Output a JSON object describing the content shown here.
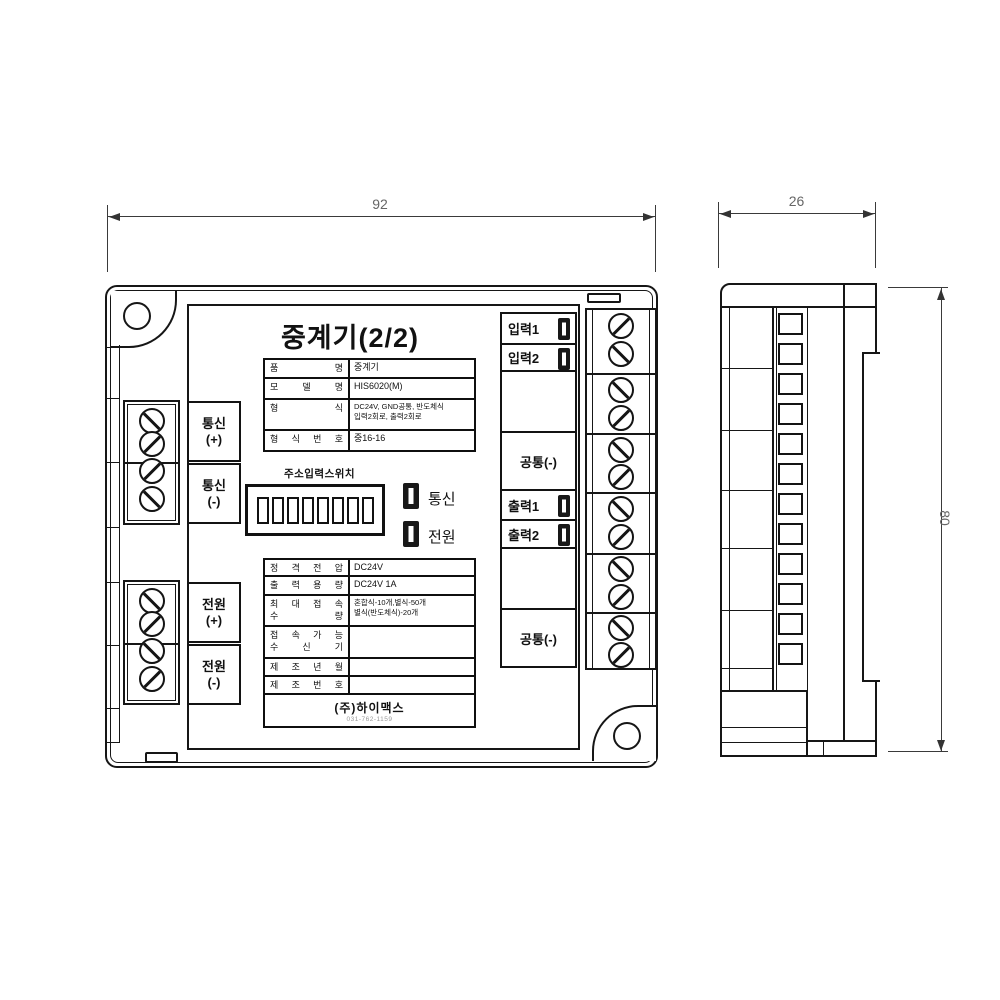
{
  "dimensions": {
    "front_width_mm": "92",
    "side_depth_mm": "26",
    "height_mm": "80"
  },
  "front": {
    "title": "중계기(2/2)",
    "dip_switch_label": "주소입력스위치",
    "status_leds": [
      {
        "label": "통신"
      },
      {
        "label": "전원"
      }
    ],
    "left_terminals": [
      {
        "name": "통신",
        "polarity": "(+)"
      },
      {
        "name": "통신",
        "polarity": "(-)"
      },
      {
        "name": "전원",
        "polarity": "(+)"
      },
      {
        "name": "전원",
        "polarity": "(-)"
      }
    ],
    "right_terminals": {
      "input1": "입력1",
      "input2": "입력2",
      "common_top": "공통(-)",
      "output1": "출력1",
      "output2": "출력2",
      "common_bottom": "공통(-)"
    },
    "spec_table": {
      "rows": [
        {
          "label": "품 명",
          "value": "중계기"
        },
        {
          "label": "모 델 명",
          "value": "HIS6020(M)"
        },
        {
          "label": "형 식",
          "value": "DC24V, GND공통, 반도체식",
          "value2": "입력2회로, 출력2회로"
        },
        {
          "label": "형 식 번 호",
          "value": "중16-16"
        }
      ]
    },
    "info_table": {
      "rows": [
        {
          "label": "정 격 전 압",
          "value": "DC24V"
        },
        {
          "label": "출 력 용 량",
          "value": "DC24V 1A"
        },
        {
          "label1": "최 대 접 속",
          "label2": "수 량",
          "value": "혼합식-10개,별식-50개",
          "value2": "별식(반도체식)-20개"
        },
        {
          "label1": "접 속 가 능",
          "label2": "수 신 기",
          "value": ""
        },
        {
          "label": "제 조 년 월",
          "value": ""
        },
        {
          "label": "제 조 번 호",
          "value": ""
        }
      ],
      "company": "(주)하이맥스",
      "company_sub": "031-762-1159"
    }
  }
}
